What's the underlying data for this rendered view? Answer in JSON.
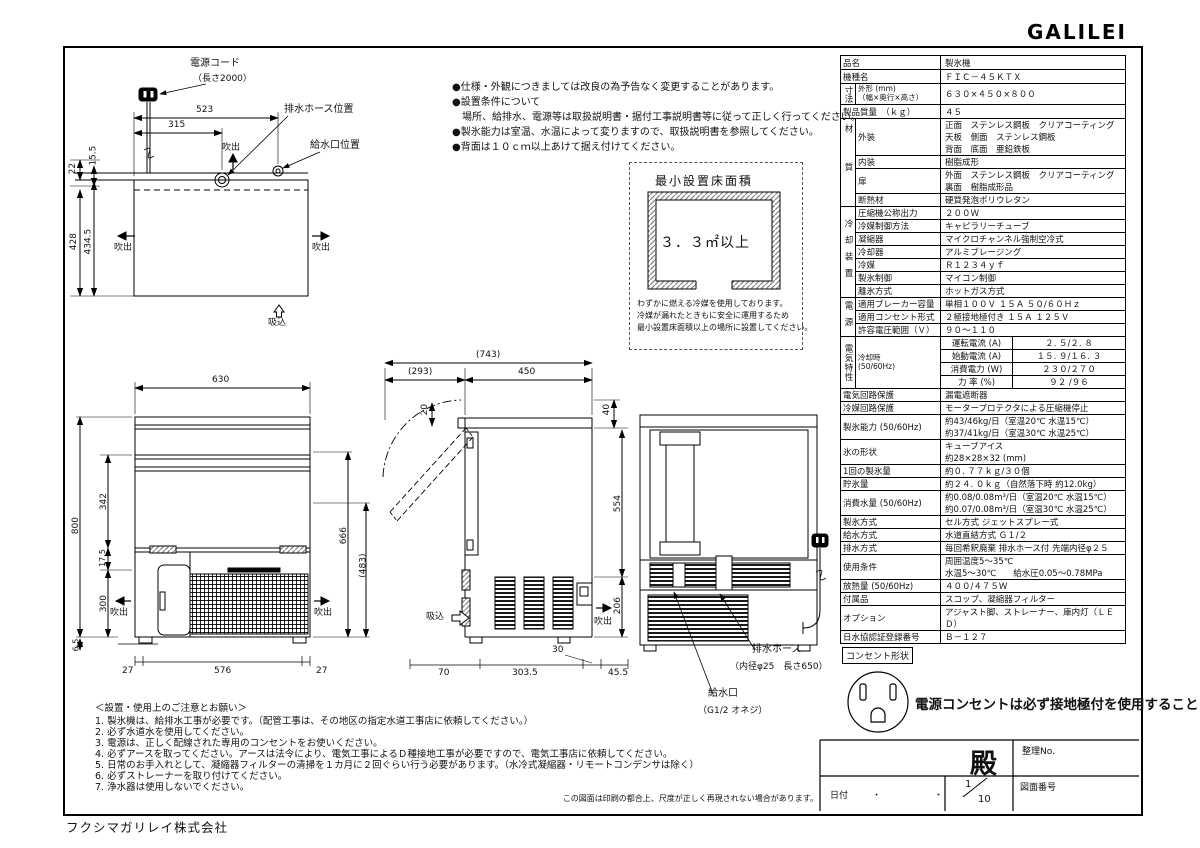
{
  "logo": "GALILEI",
  "company": "フクシマガリレイ株式会社",
  "print_note": "この図面は印刷の都合上、尺度が正しく再現されない場合があります。",
  "top_notes": [
    "●仕様・外観につきましては改良の為予告なく変更することがあります。",
    "●設置条件について",
    "　場所、給排水、電源等は取扱説明書・据付工事説明書等に従って正しく行ってください。",
    "●製氷能力は室温、水温によって変りますので、取扱説明書を参照してください。",
    "●背面は１０ｃｍ以上あけて据え付けてください。"
  ],
  "min_area": {
    "title": "最小設置床面積",
    "area": "３．３㎡以上",
    "notes": [
      "わずかに燃える冷媒を使用しております。",
      "冷媒が漏れたときもに安全に運用するため",
      "最小設置床面積以上の場所に設置してください。"
    ]
  },
  "top_view": {
    "cord_label": "電源コード",
    "cord_len": "（長さ2000）",
    "drain_label": "排水ホース位置",
    "inlet_label": "給水口位置",
    "dim_523": "523",
    "dim_315": "315",
    "dim_22": "22",
    "dim_155": "15.5",
    "dim_428": "428",
    "dim_4345": "434.5",
    "fukidashi": "吹出",
    "suikomi": "吸込"
  },
  "front_view": {
    "dim_630": "630",
    "dim_800": "800",
    "dim_342": "342",
    "dim_175": "17.5",
    "dim_300": "300",
    "dim_65": "6.5",
    "dim_27l": "27",
    "dim_576": "576",
    "dim_27r": "27",
    "dim_666": "666",
    "dim_483": "(483)",
    "fukidashi": "吹出"
  },
  "side_view": {
    "dim_743": "(743)",
    "dim_293": "(293)",
    "dim_450": "450",
    "dim_20": "20",
    "dim_40": "40",
    "dim_554": "554",
    "dim_206": "206",
    "dim_70": "70",
    "dim_3035": "303.5",
    "dim_30": "30",
    "dim_455": "45.5",
    "suikomi": "吸込",
    "fukidashi": "吹出"
  },
  "rear_view": {
    "drain_label": "排水ホース",
    "drain_spec": "（内径φ25　長さ650）",
    "inlet_label": "給水口",
    "inlet_spec": "（G1/2 オネジ）"
  },
  "cautions": {
    "title": "＜設置・使用上のご注意とお願い＞",
    "items": [
      "1. 製氷機は、給排水工事が必要です。（配管工事は、その地区の指定水道工事店に依頼してください。）",
      "2. 必ず水道水を使用してください。",
      "3. 電源は、正しく配線された専用のコンセントをお使いください。",
      "4. 必ずアースを取ってください。アースは法令により、電気工事によるＤ種接地工事が必要ですので、電気工事店に依頼してください。",
      "5. 日常のお手入れとして、凝縮器フィルターの清掃を１カ月に２回ぐらい行う必要があります。（水冷式凝縮器・リモートコンデンサは除く）",
      "6. 必ずストレーナーを取り付けてください。",
      "7. 浄水器は使用しないでください。"
    ]
  },
  "outlet": {
    "label": "コンセント形状",
    "note": "電源コンセントは必ず接地極付を使用すること"
  },
  "title_block": {
    "dono": "殿",
    "seiri_no": "整理No.",
    "date_label": "日付",
    "date_dots": "・　・",
    "scale_num": "1",
    "scale_den": "10",
    "zumen": "図面番号"
  },
  "spec": {
    "hinmei": {
      "l": "品名",
      "v": "製氷機"
    },
    "kishumei": {
      "l": "機種名",
      "v": "ＦＩＣ－４５ＫＴＸ"
    },
    "sunpo": {
      "g": "寸法",
      "l": "外形 (mm)\n（幅×奥行×高さ）",
      "v": "６３０×４５０×８００"
    },
    "juryo": {
      "l": "製品質量　（ｋｇ）",
      "v": "４５"
    },
    "zaishitsu": {
      "g": "材質",
      "rows": [
        {
          "l": "外装",
          "v": "正面　ステンレス鋼板　クリアコーティング\n天板　側面　ステンレス鋼板\n背面　底面　亜鉛鉄板"
        },
        {
          "l": "内装",
          "v": "樹脂成形"
        },
        {
          "l": "扉",
          "v": "外面　ステンレス鋼板　クリアコーティング\n裏面　樹脂成形品"
        },
        {
          "l": "断熱材",
          "v": "硬質発泡ポリウレタン"
        }
      ]
    },
    "reikyaku": {
      "g": "冷却装置",
      "rows": [
        {
          "l": "圧縮機公称出力",
          "v": "２００Ｗ"
        },
        {
          "l": "冷媒制御方法",
          "v": "キャピラリーチューブ"
        },
        {
          "l": "凝縮器",
          "v": "マイクロチャンネル強制空冷式"
        },
        {
          "l": "冷却器",
          "v": "アルミブレージング"
        },
        {
          "l": "冷媒",
          "v": "Ｒ１２３４ｙｆ"
        },
        {
          "l": "製氷制御",
          "v": "マイコン制御"
        },
        {
          "l": "離氷方式",
          "v": "ホットガス方式"
        }
      ]
    },
    "dengen": {
      "g": "電源",
      "rows": [
        {
          "l": "適用ブレーカー容量",
          "v": "単相１００Ｖ １５Ａ ５０/６０Ｈｚ"
        },
        {
          "l": "適用コンセント形式",
          "v": "２極接地極付き １５Ａ １２５Ｖ"
        },
        {
          "l": "許容電圧範囲（Ｖ）",
          "v": "９０～１１０"
        }
      ]
    },
    "denki": {
      "g": "電気特性",
      "sub": "冷却時\n(50/60Hz)",
      "rows": [
        {
          "l": "運転電流 (A)",
          "v": "２. ５/２. ８"
        },
        {
          "l": "始動電流 (A)",
          "v": "１５. ９/１６. ３"
        },
        {
          "l": "消費電力 (W)",
          "v": "２３０/２７０"
        },
        {
          "l": "力 率 (%)",
          "v": "９２ /９６"
        }
      ]
    },
    "denkikairo": {
      "l": "電気回路保護",
      "v": "漏電遮断器"
    },
    "reibaikairo": {
      "l": "冷媒回路保護",
      "v": "モータープロテクタによる圧縮機停止"
    },
    "seihyou": {
      "l": "製氷能力 (50/60Hz)",
      "v": "約43/46kg/日（室温20℃ 水温15℃）\n約37/41kg/日（室温30℃ 水温25℃）"
    },
    "koori": {
      "l": "氷の形状",
      "v": "キューブアイス\n約28×28×32 (mm)"
    },
    "ikkai": {
      "l": "1回の製氷量",
      "v": "約０. ７７ｋｇ/３０個"
    },
    "chosui": {
      "l": "貯氷量",
      "v": "約２４. ０ｋｇ（自然落下時 約12.0kg）"
    },
    "shouhisui": {
      "l": "消費水量 (50/60Hz)",
      "v": "約0.08/0.08m³/日（室温20℃ 水温15℃）\n約0.07/0.08m³/日（室温30℃ 水温25℃）"
    },
    "seihyou_hoshiki": {
      "l": "製氷方式",
      "v": "セル方式 ジェットスプレー式"
    },
    "kyusui": {
      "l": "給水方式",
      "v": "水道直結方式 Ｇ１/２"
    },
    "haisui": {
      "l": "排水方式",
      "v": "毎回希釈廃棄 排水ホース付 先端内径φ２５"
    },
    "shiyo": {
      "l": "使用条件",
      "v": "周囲温度5～35℃\n水温5～30℃　　給水圧0.05～0.78MPa"
    },
    "honetsu": {
      "l": "放熱量 (50/60Hz)",
      "v": "４００/４７５Ｗ"
    },
    "fuzoku": {
      "l": "付属品",
      "v": "スコップ、凝縮器フィルター"
    },
    "option": {
      "l": "オプション",
      "v": "アジャスト脚、ストレーナー、庫内灯（ＬＥＤ）"
    },
    "nissuikyo": {
      "l": "日水協認証登録番号",
      "v": "Ｂ－１２７"
    }
  }
}
